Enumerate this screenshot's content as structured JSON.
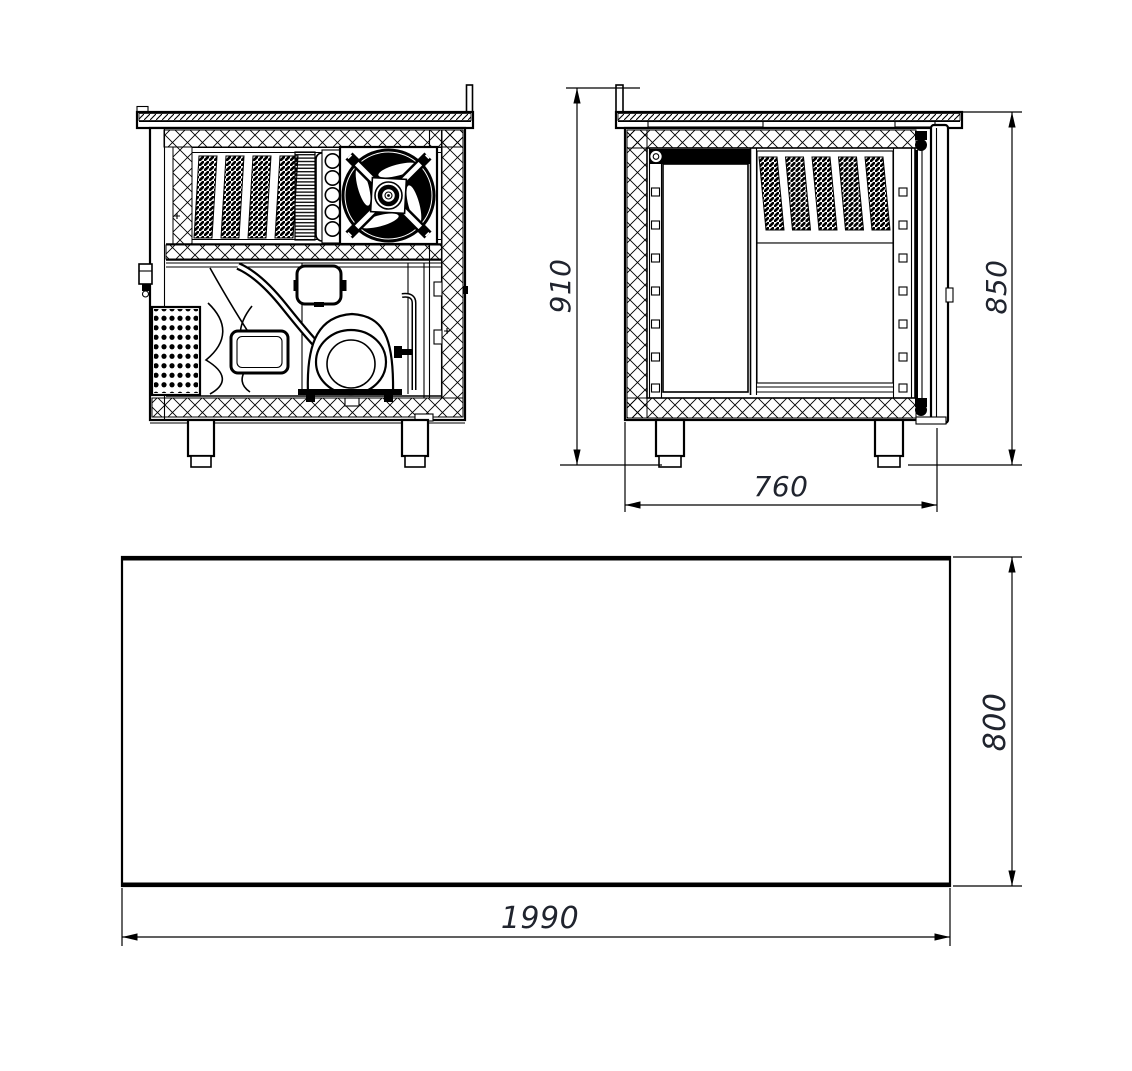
{
  "drawing": {
    "type": "technical-drawing",
    "subject": "refrigerated-counter",
    "colors": {
      "line": "#000000",
      "dimension_text": "#20242e",
      "background": "#ffffff"
    },
    "views": {
      "front": {
        "name": "machinery-end-elevation"
      },
      "side": {
        "name": "cross-section-side-view"
      },
      "plan": {
        "name": "plan-view"
      }
    },
    "dimensions": {
      "overall_height": "910",
      "body_height": "850",
      "depth": "760",
      "length": "1990",
      "plan_depth": "800"
    }
  }
}
